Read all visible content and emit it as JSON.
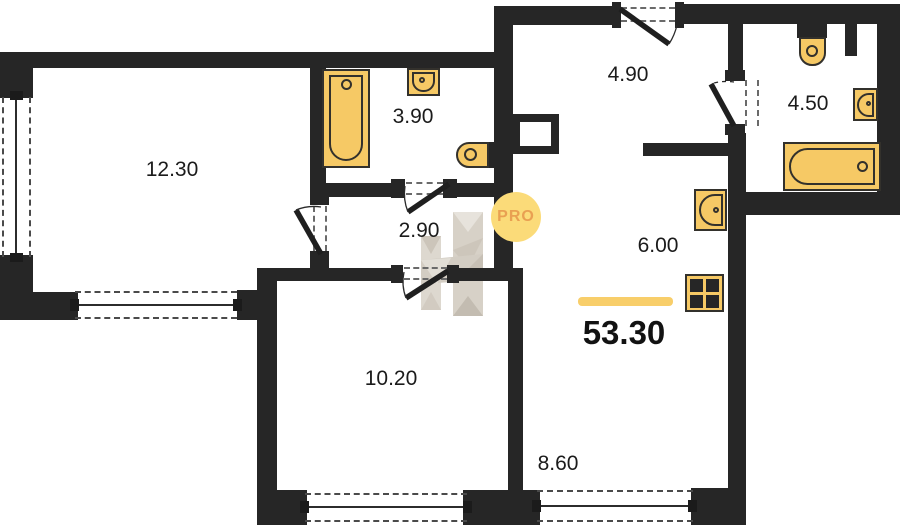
{
  "plan": {
    "type": "apartment-floor-plan",
    "total_area": "53.30",
    "rooms": [
      {
        "id": "room-12-30",
        "area": "12.30"
      },
      {
        "id": "room-3-90",
        "area": "3.90"
      },
      {
        "id": "room-2-90",
        "area": "2.90"
      },
      {
        "id": "room-4-90",
        "area": "4.90"
      },
      {
        "id": "room-4-50",
        "area": "4.50"
      },
      {
        "id": "room-6-00",
        "area": "6.00"
      },
      {
        "id": "room-10-20",
        "area": "10.20"
      },
      {
        "id": "room-8-60",
        "area": "8.60"
      }
    ],
    "badge": {
      "text": "PRO"
    },
    "icons": [
      "bathtub-icon",
      "sink-icon",
      "toilet-icon",
      "stove-icon",
      "window",
      "door-swing"
    ],
    "colors": {
      "wall": "#262626",
      "fixture_fill": "#F6C965",
      "fixture_border": "#33312C",
      "accent_bar": "#F8CE6A",
      "badge_fill": "#FBDB79",
      "badge_text": "#E9A052",
      "label_text": "#1B1B1B"
    }
  }
}
